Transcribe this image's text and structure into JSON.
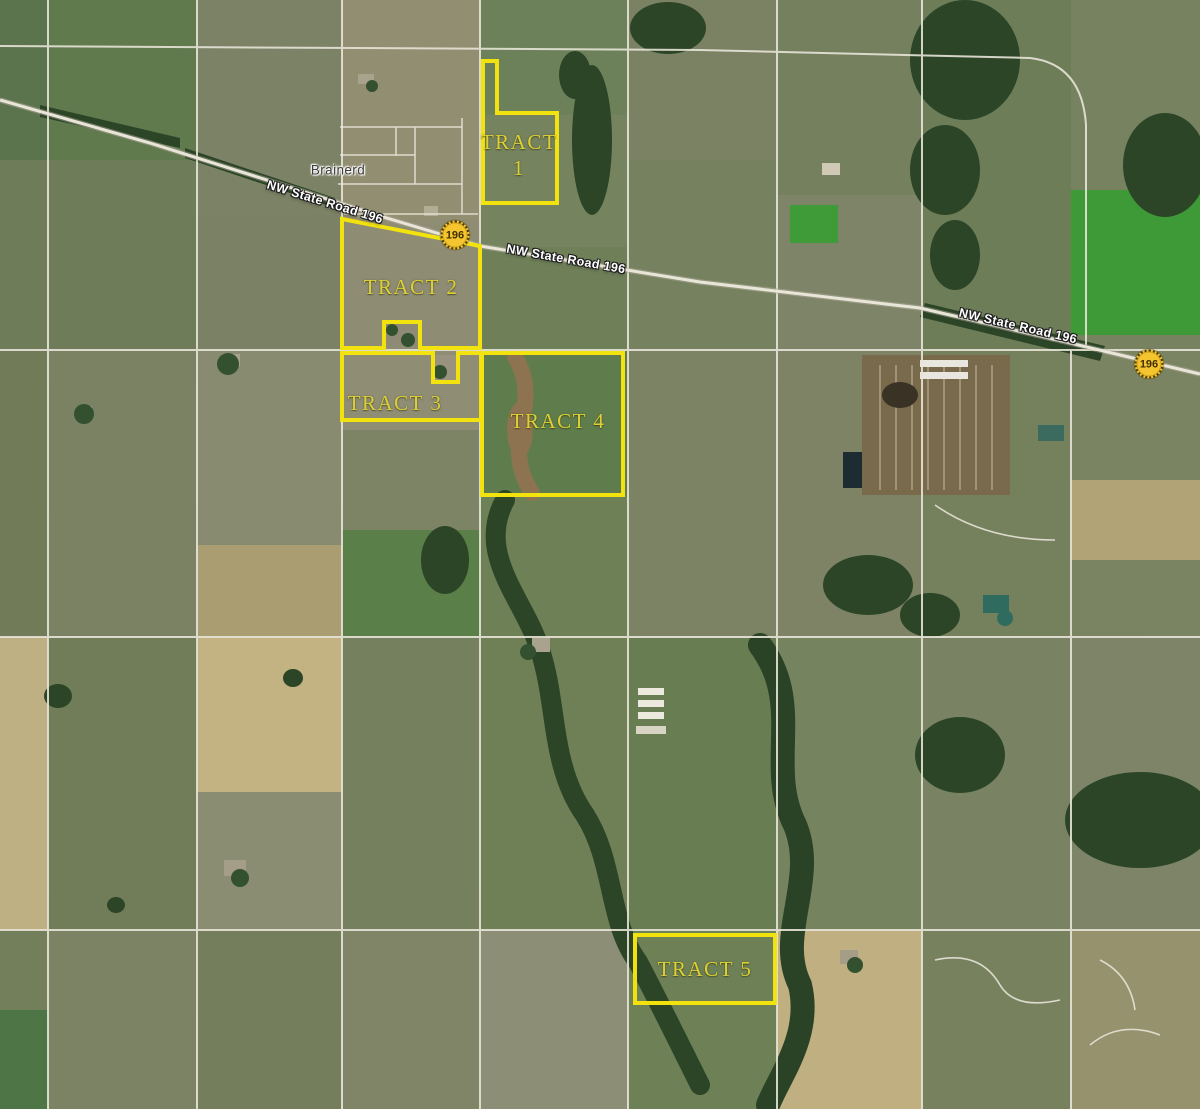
{
  "colors": {
    "tract_outline": "#f2e20e",
    "tract_text": "#ddd036",
    "shield_fill": "#f4c52e",
    "shield_border": "#4f3a00",
    "shield_text": "#422f00",
    "road_label_text": "#ffffff",
    "place_text": "#3d3d3d"
  },
  "map": {
    "place_name": "Brainerd",
    "route_shield": "196",
    "road_name": "NW State Road 196",
    "tracts": [
      {
        "name": "TRACT 1",
        "line1": "TRACT",
        "line2": "1"
      },
      {
        "name": "TRACT 2"
      },
      {
        "name": "TRACT 3"
      },
      {
        "name": "TRACT 4"
      },
      {
        "name": "TRACT 5"
      }
    ]
  }
}
